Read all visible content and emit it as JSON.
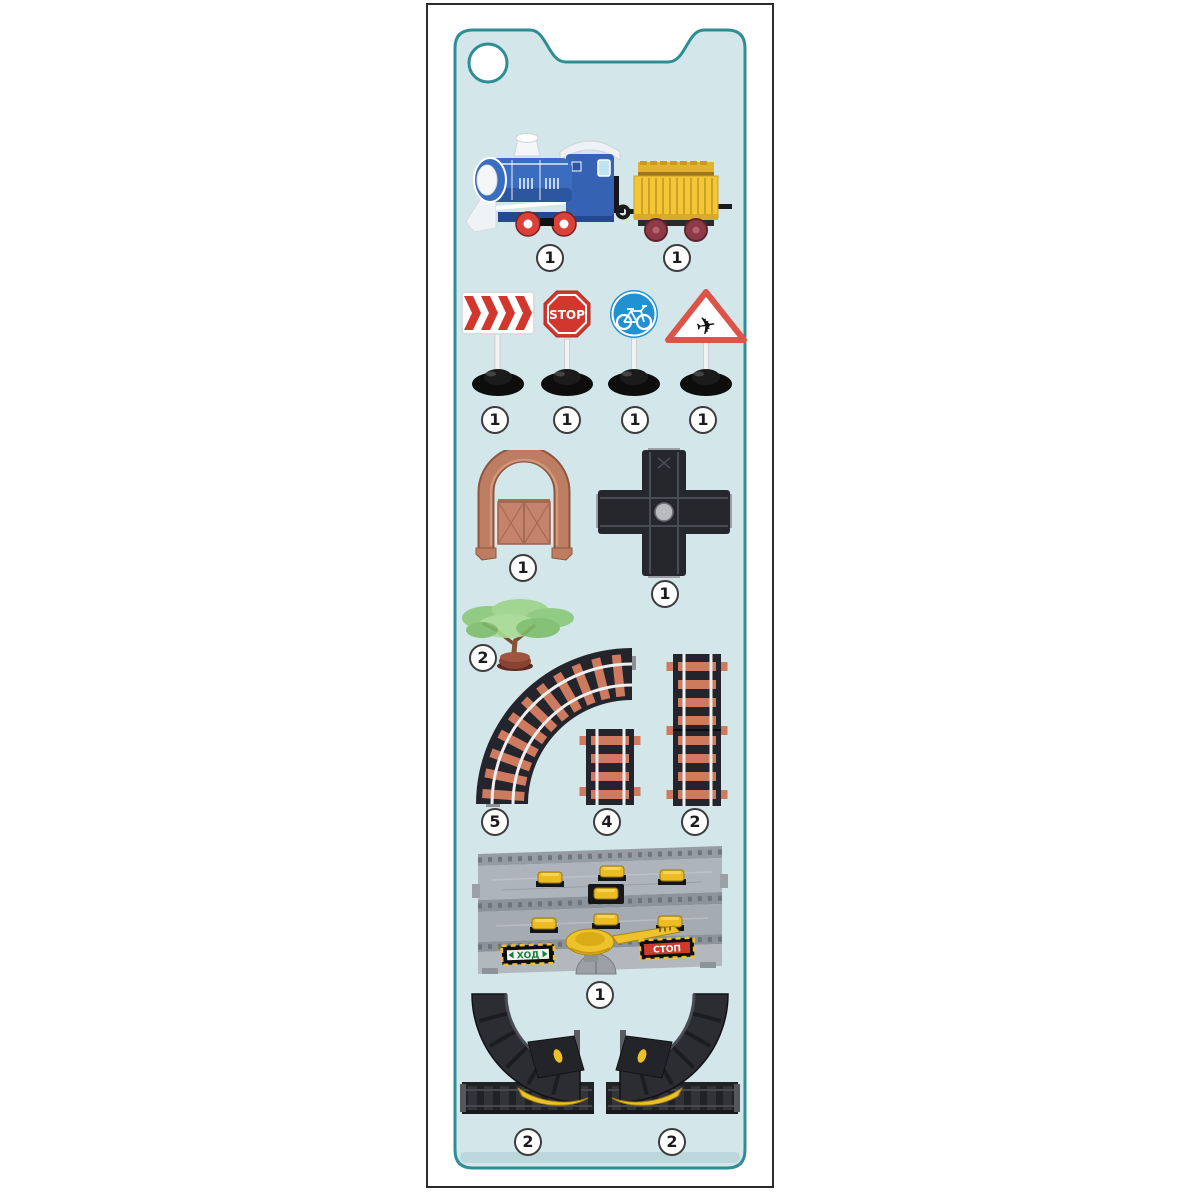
{
  "card": {
    "background": "#d3e6ea",
    "border_color": "#2e8d95",
    "frame_border": "#2b2b2b"
  },
  "parts": {
    "locomotive": {
      "qty": "1"
    },
    "wagon": {
      "qty": "1"
    },
    "sign_chevron": {
      "qty": "1"
    },
    "sign_stop": {
      "qty": "1",
      "text": "STOP"
    },
    "sign_bicycle": {
      "qty": "1"
    },
    "sign_airplane": {
      "qty": "1"
    },
    "arch": {
      "qty": "1"
    },
    "cross_track": {
      "qty": "1"
    },
    "tree": {
      "qty": "2"
    },
    "curved_track": {
      "qty": "5"
    },
    "straight_track_short": {
      "qty": "4"
    },
    "straight_track_long": {
      "qty": "2"
    },
    "crossing_platform": {
      "qty": "1",
      "go_label": "ХОД",
      "stop_label": "СТОП"
    },
    "ramp_left": {
      "qty": "2"
    },
    "ramp_right": {
      "qty": "2"
    }
  },
  "colors": {
    "sign_red": "#d2372e",
    "sign_blue": "#2191d2",
    "track_sleeper": "#cd7a5f",
    "track_bed": "#24252c",
    "arch_brown": "#bd7d60",
    "wagon_yellow": "#f3c636",
    "locomotive_blue": "#3a6cc0",
    "platform_gray": "#a5abb2",
    "accent_yellow": "#ecc12a",
    "go_green": "#17813a",
    "stop_red": "#d03a2c"
  }
}
